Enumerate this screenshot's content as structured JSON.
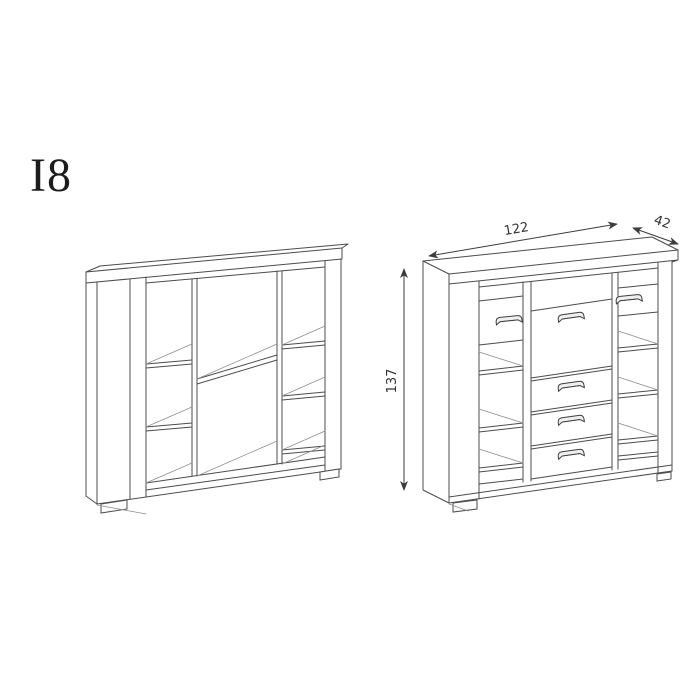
{
  "page": {
    "background": "#ffffff"
  },
  "model_label": "I8",
  "dimensions": {
    "width": "122",
    "depth": "42",
    "height": "137"
  },
  "colors": {
    "line": "#4c4c4c",
    "light_line": "#8e8e8e",
    "dimension_text": "#333333",
    "label_text": "#1c1c1c"
  }
}
